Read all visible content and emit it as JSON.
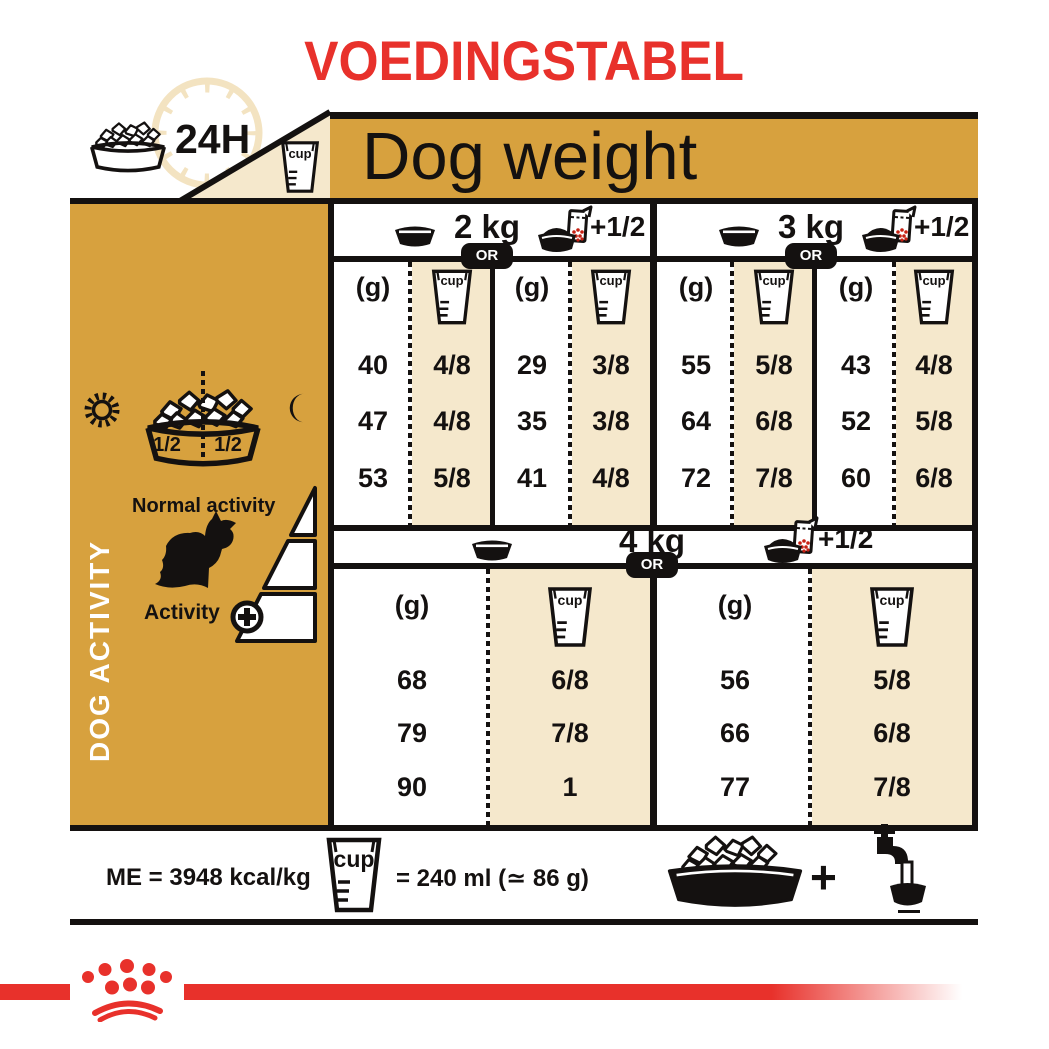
{
  "title": "VOEDINGSTABEL",
  "colors": {
    "gold": "#D7A13E",
    "cream": "#F5E8CC",
    "red": "#E8312B",
    "black": "#141110"
  },
  "header": {
    "dog_weight": "Dog weight",
    "hours": "24H"
  },
  "labels": {
    "g": "(g)",
    "cup": "cup",
    "or": "OR",
    "plus_half": "+1/2"
  },
  "sidebar": {
    "vertical_label": "DOG ACTIVITY",
    "half_left": "1/2",
    "half_right": "1/2",
    "normal_activity": "Normal activity",
    "activity": "Activity",
    "plus": "+"
  },
  "table_top": {
    "sections": [
      {
        "weight": "2 kg",
        "dry_g": [
          "40",
          "47",
          "53"
        ],
        "dry_cup": [
          "4/8",
          "4/8",
          "5/8"
        ],
        "mix_g": [
          "29",
          "35",
          "41"
        ],
        "mix_cup": [
          "3/8",
          "3/8",
          "4/8"
        ]
      },
      {
        "weight": "3 kg",
        "dry_g": [
          "55",
          "64",
          "72"
        ],
        "dry_cup": [
          "5/8",
          "6/8",
          "7/8"
        ],
        "mix_g": [
          "43",
          "52",
          "60"
        ],
        "mix_cup": [
          "4/8",
          "5/8",
          "6/8"
        ]
      }
    ]
  },
  "table_bottom": {
    "weight": "4 kg",
    "dry_g": [
      "68",
      "79",
      "90"
    ],
    "dry_cup": [
      "6/8",
      "7/8",
      "1"
    ],
    "mix_g": [
      "56",
      "66",
      "77"
    ],
    "mix_cup": [
      "5/8",
      "6/8",
      "7/8"
    ]
  },
  "footer": {
    "me": "ME = 3948 kcal/kg",
    "equivalence": "= 240 ml (≃ 86 g)",
    "plus": "+"
  },
  "icons": [
    "kibble-bowl-icon",
    "clock-24h-icon",
    "measuring-cup-icon",
    "empty-bowl-icon",
    "bowl-pouch-icon",
    "sun-icon",
    "moon-icon",
    "dog-silhouette-icon",
    "plus-circle-icon",
    "activity-ramp-icon",
    "faucet-water-icon",
    "royal-canin-crown-icon"
  ]
}
